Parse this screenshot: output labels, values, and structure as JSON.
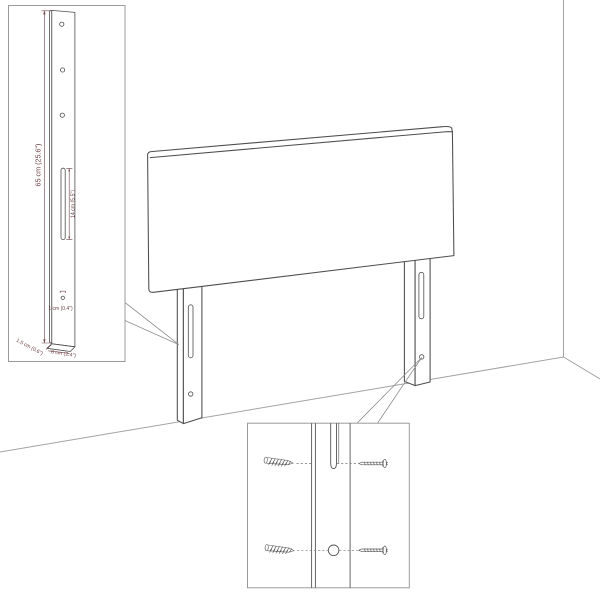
{
  "colors": {
    "background": "#ffffff",
    "furniture_outline": "#4d4d4d",
    "room_line": "#a3a3a3",
    "inset_border": "#9b9b9b",
    "callout_line": "#8f8f8f",
    "dimension_text": "#6e4348",
    "screw_line": "#555555"
  },
  "dimensions": {
    "leg_height": "65 cm (25.6\")",
    "slot_length": "14 cm (5.5\")",
    "hole_diameter": "1 cm (0.4\")",
    "leg_thickness": "1.5 cm (0.6\")",
    "leg_width": "6 cm (2.4\")"
  }
}
